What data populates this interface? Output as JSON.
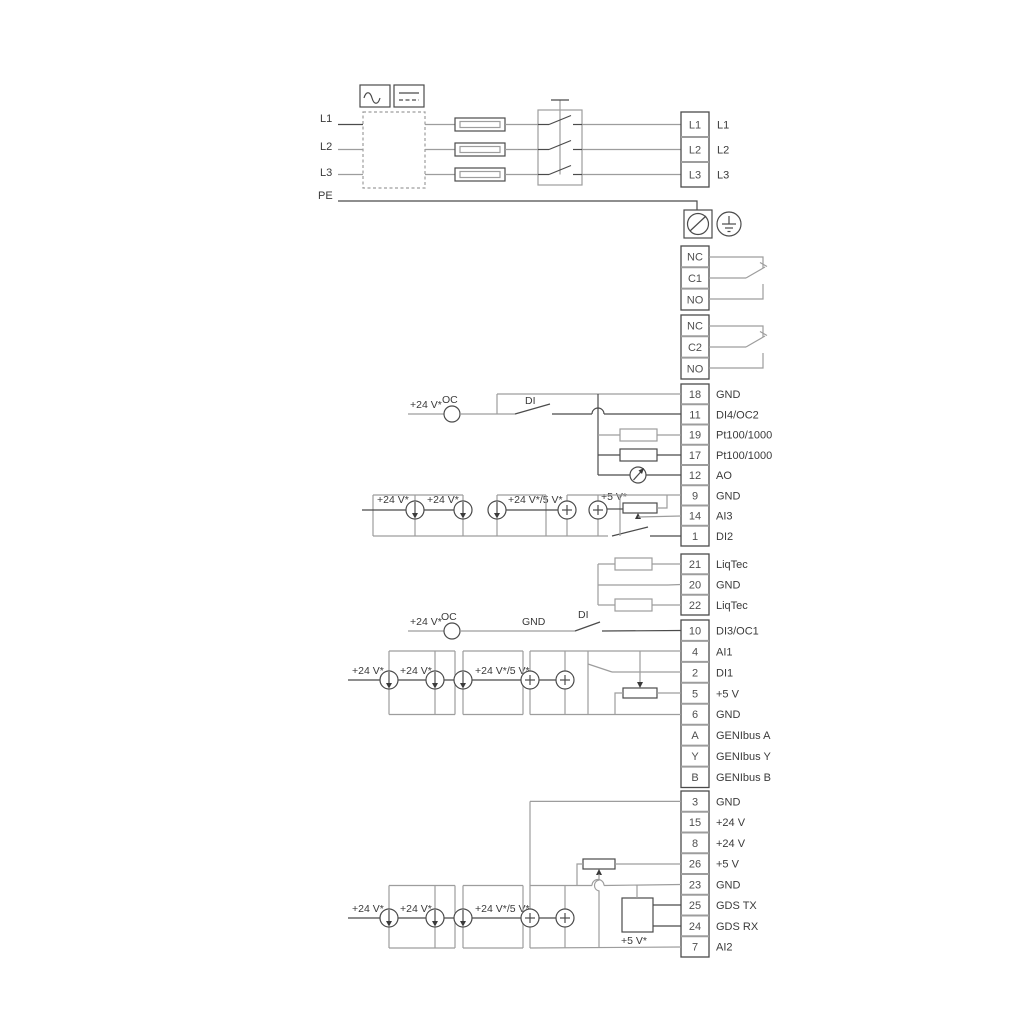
{
  "diagram": {
    "title_hint": "pump terminal wiring diagram",
    "mains_in": {
      "l1": "L1",
      "l2": "L2",
      "l3": "L3",
      "pe": "PE"
    },
    "mains_out": {
      "l1": "L1",
      "l2": "L2",
      "l3": "L3"
    },
    "relay1": {
      "nc": "NC",
      "c": "C1",
      "no": "NO"
    },
    "relay2": {
      "nc": "NC",
      "c": "C2",
      "no": "NO"
    },
    "blockA": {
      "rows": [
        {
          "num": "18",
          "label": "GND"
        },
        {
          "num": "11",
          "label": "DI4/OC2"
        },
        {
          "num": "19",
          "label": "Pt100/1000"
        },
        {
          "num": "17",
          "label": "Pt100/1000"
        },
        {
          "num": "12",
          "label": "AO"
        },
        {
          "num": "9",
          "label": "GND"
        },
        {
          "num": "14",
          "label": "AI3"
        },
        {
          "num": "1",
          "label": "DI2"
        }
      ]
    },
    "blockB": {
      "rows": [
        {
          "num": "21",
          "label": "LiqTec"
        },
        {
          "num": "20",
          "label": "GND"
        },
        {
          "num": "22",
          "label": "LiqTec"
        }
      ]
    },
    "blockC": {
      "rows": [
        {
          "num": "10",
          "label": "DI3/OC1"
        },
        {
          "num": "4",
          "label": "AI1"
        },
        {
          "num": "2",
          "label": "DI1"
        },
        {
          "num": "5",
          "label": "+5 V"
        },
        {
          "num": "6",
          "label": "GND"
        },
        {
          "num": "A",
          "label": "GENIbus A"
        },
        {
          "num": "Y",
          "label": "GENIbus Y"
        },
        {
          "num": "B",
          "label": "GENIbus B"
        }
      ]
    },
    "blockD": {
      "rows": [
        {
          "num": "3",
          "label": "GND"
        },
        {
          "num": "15",
          "label": "+24 V"
        },
        {
          "num": "8",
          "label": "+24 V"
        },
        {
          "num": "26",
          "label": "+5 V"
        },
        {
          "num": "23",
          "label": "GND"
        },
        {
          "num": "25",
          "label": "GDS TX"
        },
        {
          "num": "24",
          "label": "GDS RX"
        },
        {
          "num": "7",
          "label": "AI2"
        }
      ]
    },
    "ann": {
      "oc2": {
        "supply": "+24 V*",
        "oc": "OC",
        "di": "DI"
      },
      "ai3": {
        "s1": "+24 V*",
        "s2": "+24 V*",
        "s3": "+24 V*/5 V*",
        "s4": "+5 V*"
      },
      "oc1": {
        "supply": "+24 V*",
        "oc": "OC",
        "gnd": "GND",
        "di": "DI"
      },
      "ai1": {
        "s1": "+24 V*",
        "s2": "+24 V*",
        "s3": "+24 V*/5 V*"
      },
      "ai2": {
        "s1": "+24 V*",
        "s2": "+24 V*",
        "s3": "+24 V*/5 V*",
        "s4": "+5 V*"
      }
    },
    "colors": {
      "line_gray": "#9d9d9d",
      "line_dark": "#4b4b4b",
      "text": "#3a3a3a",
      "background": "#ffffff"
    }
  }
}
